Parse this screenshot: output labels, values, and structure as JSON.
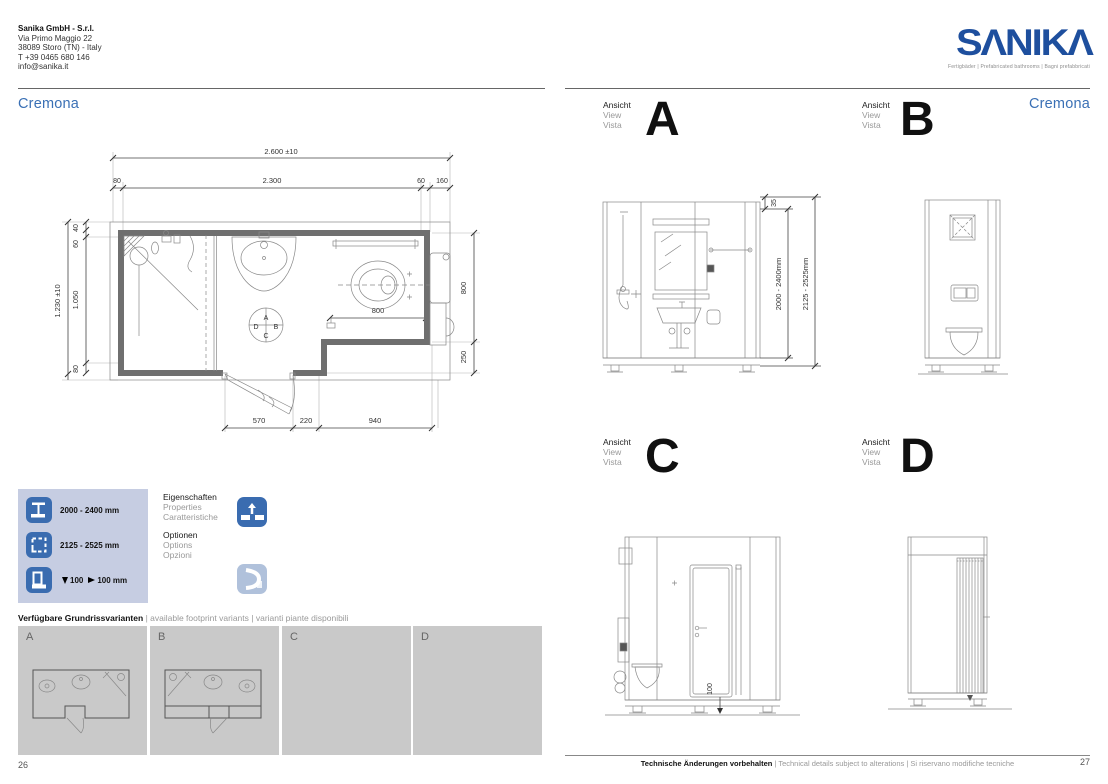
{
  "brand": {
    "logo_display": "SΛNIKΛ",
    "tagline": "Fertigbäder | Prefabricated bathrooms | Bagni prefabbricati",
    "logo_blue": "#1e4f9e",
    "title_blue": "#3a70b5"
  },
  "company": {
    "name": "Sanika GmbH - S.r.l.",
    "address1": "Via Primo Maggio 22",
    "address2": "38089 Storo (TN) - Italy",
    "phone": "T +39 0465 680 146",
    "email": "info@sanika.it"
  },
  "left_page": {
    "title": "Cremona",
    "page_number": "26",
    "plan": {
      "dim_overall_w": "2.600  ±10",
      "dim_80": "80",
      "dim_2300": "2.300",
      "dim_60": "60",
      "dim_160": "160",
      "dim_overall_h": "1.230  ±10",
      "dim_40": "40",
      "dim_60b": "60",
      "dim_1050": "1.050",
      "dim_80b": "80",
      "dim_800_right": "800",
      "dim_250": "250",
      "dim_800_inner": "800",
      "dim_570": "570",
      "dim_220": "220",
      "dim_940": "940",
      "compass_a": "A",
      "compass_b": "B",
      "compass_c": "C",
      "compass_d": "D"
    },
    "legend": {
      "internal_height": "2000 - 2400 mm",
      "external_height": "2125 - 2525 mm",
      "recess_down": "100",
      "recess_right": "100 mm"
    },
    "properties": {
      "de": "Eigenschaften",
      "en": "Properties",
      "it": "Caratteristiche"
    },
    "options": {
      "de": "Optionen",
      "en": "Options",
      "it": "Opzioni"
    },
    "variants": {
      "heading_de": "Verfügbare Grundrissvarianten",
      "heading_en": "available footprint variants",
      "heading_it": "varianti piante disponibili",
      "a": "A",
      "b": "B",
      "c": "C",
      "d": "D"
    }
  },
  "right_page": {
    "title": "Cremona",
    "page_number": "27",
    "view_label": {
      "de": "Ansicht",
      "en": "View",
      "it": "Vista"
    },
    "views": {
      "a": "A",
      "b": "B",
      "c": "C",
      "d": "D"
    },
    "dims": {
      "top_35": "35",
      "internal_height": "2000 - 2400mm",
      "external_height": "2125 - 2525mm",
      "plinth": "100"
    },
    "footer": {
      "de": "Technische Änderungen vorbehalten",
      "en": "Technical details subject to alterations",
      "it": "Si riservano modifiche tecniche"
    }
  }
}
